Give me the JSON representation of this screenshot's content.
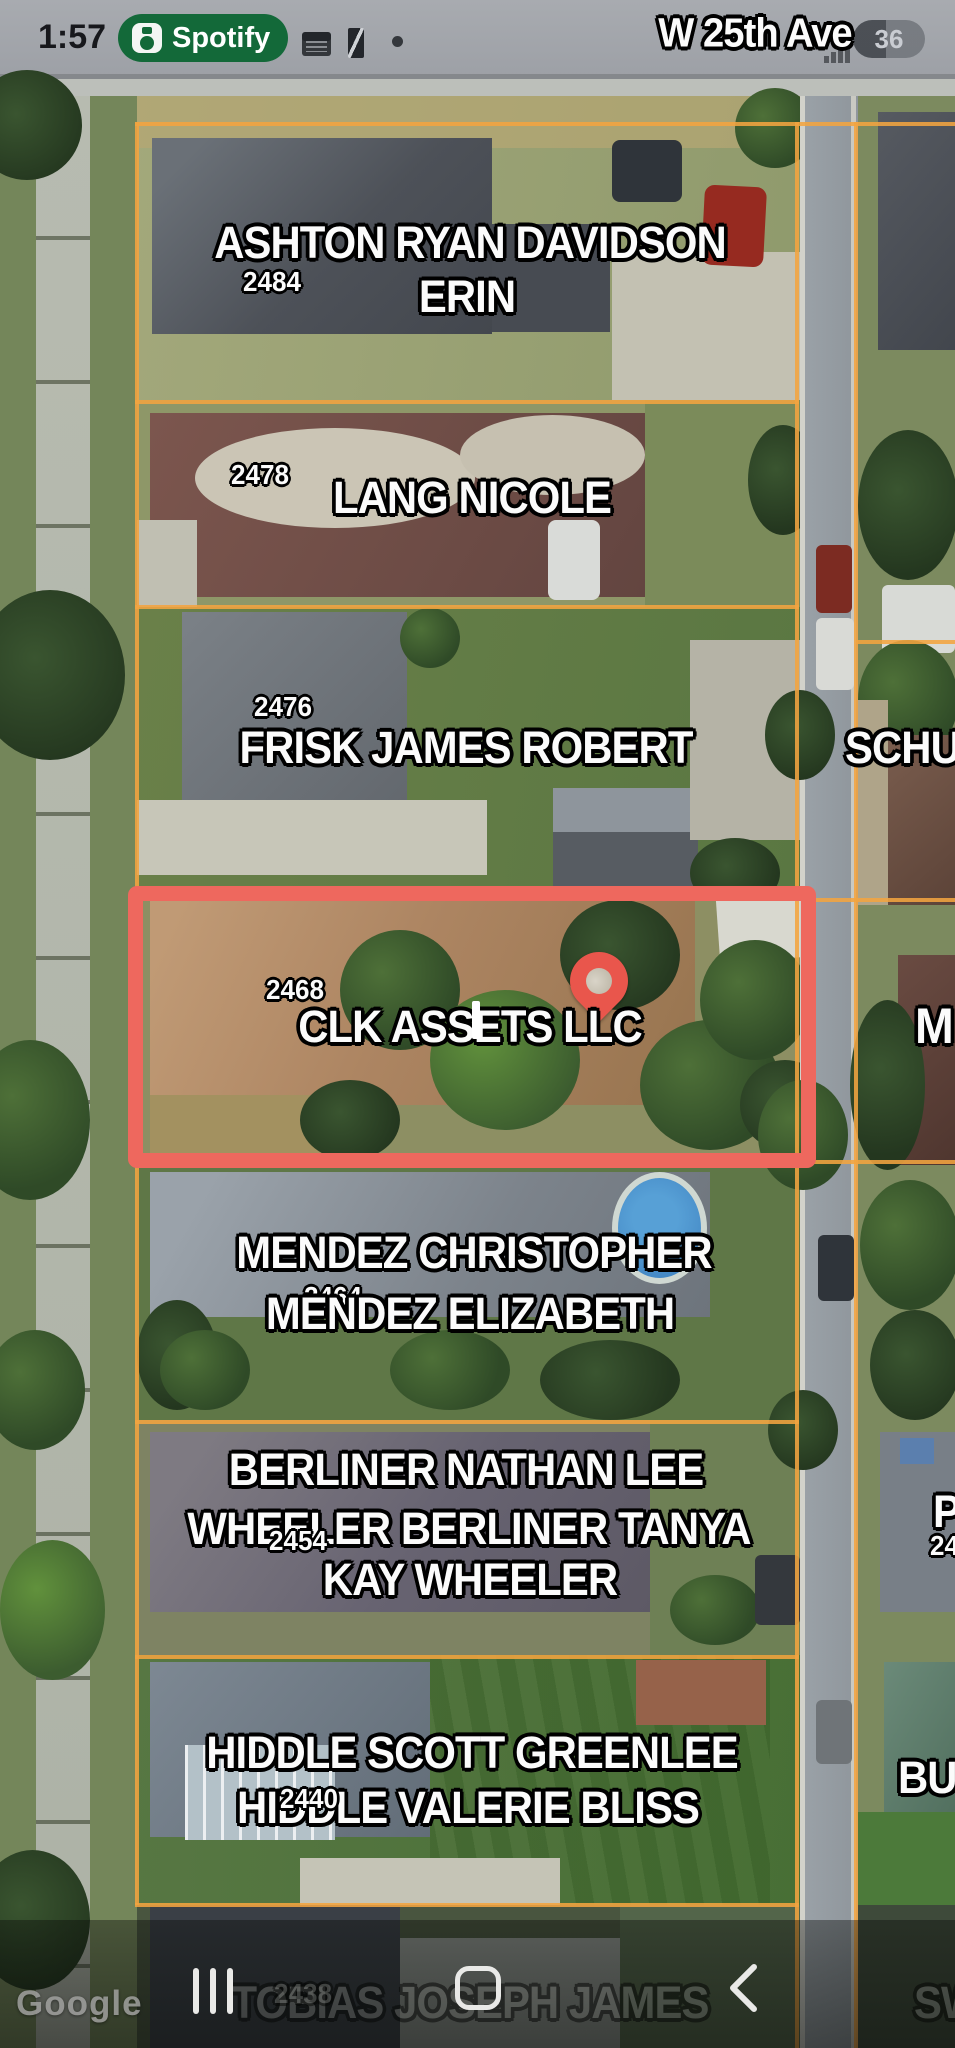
{
  "status_bar": {
    "time": "1:57",
    "spotify_label": "Spotify",
    "battery_percent": "36",
    "icons": [
      "spotify-speaker-icon",
      "calendar-icon",
      "nba-app-icon",
      "privacy-dot",
      "signal-bars",
      "battery-pill"
    ]
  },
  "map": {
    "street_label": "W 25th Ave",
    "watermark": "Google",
    "parcels": [
      {
        "address": "2484",
        "line1": "ASHTON RYAN DAVIDSON",
        "line2": "ERIN"
      },
      {
        "address": "2478",
        "line1": "LANG NICOLE"
      },
      {
        "address": "2476",
        "line1": "FRISK JAMES ROBERT"
      },
      {
        "address": "2468",
        "line1": "CLK ASSETS LLC",
        "highlighted": true
      },
      {
        "address": "2464",
        "line1": "MENDEZ CHRISTOPHER",
        "line2": "MENDEZ ELIZABETH"
      },
      {
        "address": "2454",
        "line1": "BERLINER NATHAN LEE",
        "line2": "WHEELER BERLINER TANYA",
        "line3": "KAY WHEELER"
      },
      {
        "address": "2440",
        "line1": "HIDDLE SCOTT GREENLEE",
        "line2": "HIDDLE VALERIE BLISS"
      },
      {
        "address": "2438",
        "line1": "TOBIAS JOSEPH JAMES"
      }
    ],
    "edge_labels": {
      "right_frisk": "SCHU",
      "right_clk": "M",
      "right_berliner_name": "P",
      "right_berliner_address": "24",
      "right_hiddle": "BUT",
      "right_tobias": "SW"
    },
    "colors": {
      "parcel_line": "#f2a440",
      "highlight_box": "#ee685e",
      "pin": "#e9564c",
      "spotify_green": "#136939"
    }
  },
  "nav_bar": {
    "icons": [
      "recents-icon",
      "home-icon",
      "back-icon"
    ]
  }
}
